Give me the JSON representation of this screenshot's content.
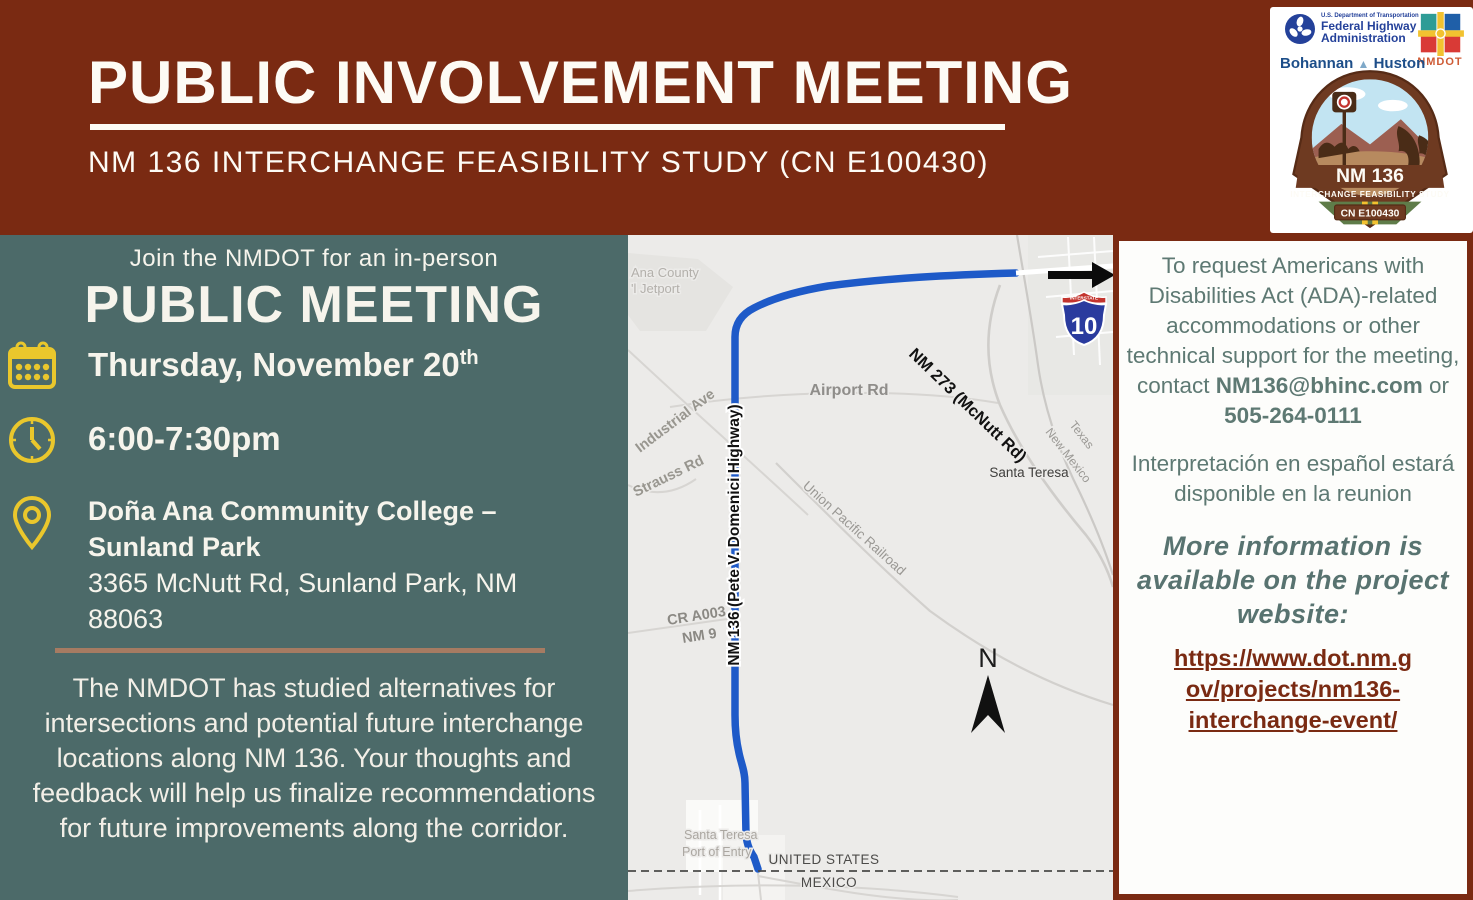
{
  "header": {
    "title": "PUBLIC INVOLVEMENT MEETING",
    "subtitle": "NM 136 INTERCHANGE FEASIBILITY STUDY (CN E100430)"
  },
  "logos": {
    "fhwa_dept": "U.S. Department of Transportation",
    "fhwa_line1": "Federal Highway",
    "fhwa_line2": "Administration",
    "bohannan": "Bohannan",
    "huston": "Huston",
    "nmdot": "NMDOT",
    "badge_route": "NM 136",
    "badge_study": "INTERCHANGE FEASIBILITY STUDY",
    "badge_cn": "CN E100430"
  },
  "left": {
    "intro": "Join the NMDOT for an in-person",
    "meeting_title": "PUBLIC MEETING",
    "date_main": "Thursday, November 20",
    "date_ordinal": "th",
    "time": "6:00-7:30pm",
    "venue_line1": "Doña Ana Community College –",
    "venue_line2": "Sunland Park",
    "address_line1": "3365 McNutt Rd, Sunland Park, NM",
    "address_line2": "88063",
    "body": "The NMDOT has studied alternatives for intersections and potential future interchange locations along NM 136. Your thoughts and feedback will help us finalize recommendations for future improvements along the corridor."
  },
  "map": {
    "ana_county": "Ana County",
    "jetport": "'l Jetport",
    "industrial_ave": "Industrial Ave",
    "strauss_rd": "Strauss Rd",
    "airport_rd": "Airport Rd",
    "nm273": "NM 273 (McNutt Rd)",
    "texas": "Texas",
    "new_mexico": "New Mexico",
    "santa_teresa": "Santa Teresa",
    "railroad": "Union Pacific Railroad",
    "cr_a003": "CR A003",
    "nm9": "NM 9",
    "nm136": "NM 136 (Pete V. Domenici Highway)",
    "north": "N",
    "port_line1": "Santa Teresa",
    "port_line2": "Port of Entry",
    "united_states": "UNITED STATES",
    "mexico": "MEXICO",
    "interstate": "INTERSTATE",
    "i10": "10"
  },
  "right": {
    "ada_text": "To request Americans with Disabilities Act (ADA)-related accommodations or other technical support for the meeting, contact ",
    "email": "NM136@bhinc.com",
    "or_label": " or",
    "phone": "505-264-0111",
    "spanish": "Interpretación en español estará disponible en la reunion",
    "more_info": "More information is available on the project website:",
    "link_line1": "https://www.dot.nm.g",
    "link_line2": "ov/projects/nm136-",
    "link_line3": "interchange-event/"
  },
  "colors": {
    "maroon": "#7A2A12",
    "teal": "#4C6A69",
    "yellow": "#EAC72C",
    "route_blue": "#1E5AC8",
    "divider_tan": "#A67B62",
    "panel_text_green": "#5E7973"
  }
}
